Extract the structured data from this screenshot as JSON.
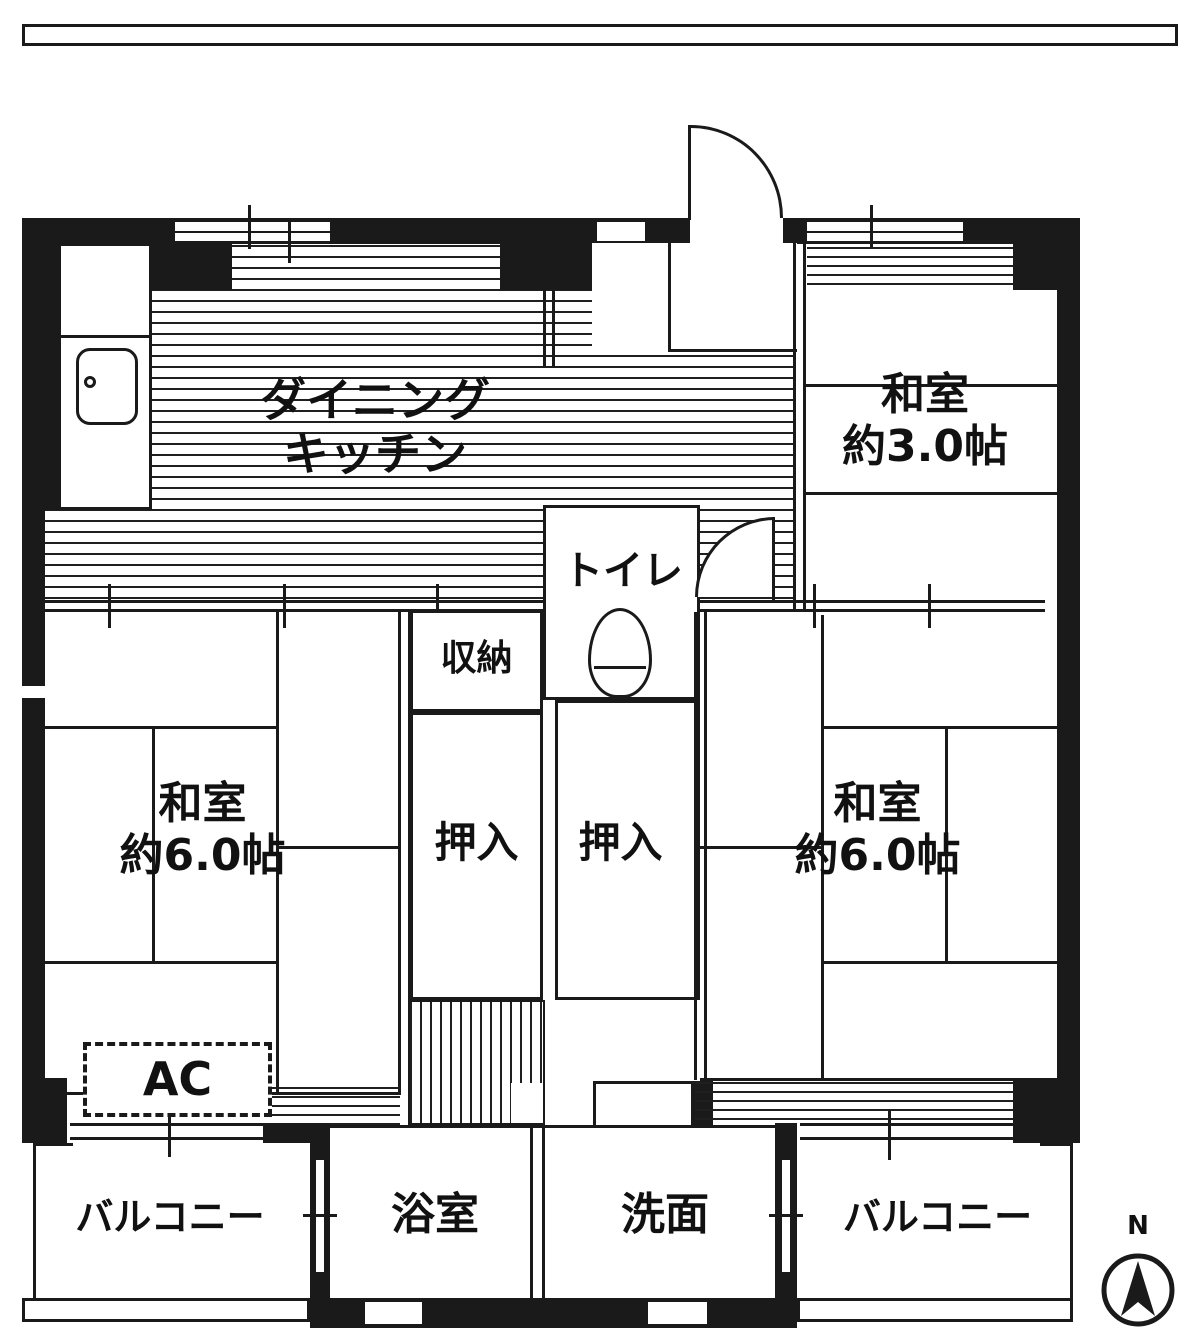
{
  "plan": {
    "rooms": {
      "dining_kitchen": {
        "line1": "ダイニング",
        "line2": "キッチン"
      },
      "washitsu_3": {
        "line1": "和室",
        "line2": "約3.0帖"
      },
      "toilet": {
        "label": "トイレ"
      },
      "storage": {
        "label": "収納"
      },
      "closet_left": {
        "label": "押入"
      },
      "closet_right": {
        "label": "押入"
      },
      "washitsu_6_left": {
        "line1": "和室",
        "line2": "約6.0帖"
      },
      "washitsu_6_right": {
        "line1": "和室",
        "line2": "約6.0帖"
      },
      "ac_unit": {
        "label": "AC"
      },
      "balcony_left": {
        "label": "バルコニー"
      },
      "bathroom": {
        "label": "浴室"
      },
      "washroom": {
        "label": "洗面"
      },
      "balcony_right": {
        "label": "バルコニー"
      }
    },
    "compass": {
      "label": "N"
    },
    "colors": {
      "line": "#1a1a1a",
      "background": "#ffffff"
    }
  }
}
